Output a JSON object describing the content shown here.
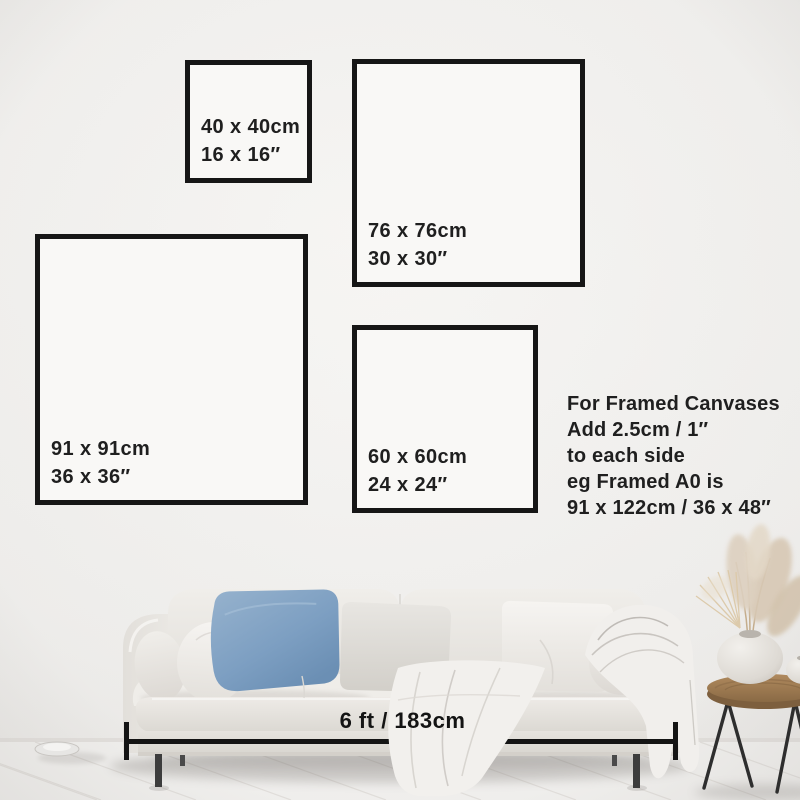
{
  "size_guide": {
    "squares": [
      {
        "name": "40x40",
        "cm_label": "40 x 40cm",
        "in_label": "16 x 16″"
      },
      {
        "name": "76x76",
        "cm_label": "76 x 76cm",
        "in_label": "30 x 30″"
      },
      {
        "name": "91x91",
        "cm_label": "91 x 91cm",
        "in_label": "36 x 36″"
      },
      {
        "name": "60x60",
        "cm_label": "60 x 60cm",
        "in_label": "24 x 24″"
      }
    ],
    "framed_note": {
      "lines": [
        "For Framed Canvases",
        "Add 2.5cm / 1″",
        "to each side",
        "eg Framed A0 is",
        "91 x 122cm / 36 x 48″"
      ]
    },
    "dimension": {
      "label": "6 ft / 183cm"
    }
  },
  "palette": {
    "frame_border": "#161616",
    "text": "#1f1f1f",
    "wall": "#f1f0ee",
    "floor": "#f3f2f0",
    "sofa": "#eae7e3",
    "blue_pillow": "#7d9fc2",
    "wood_stool": "#a07c52",
    "pampas": "#d8c9b5",
    "legs": "#3d3d3d"
  }
}
